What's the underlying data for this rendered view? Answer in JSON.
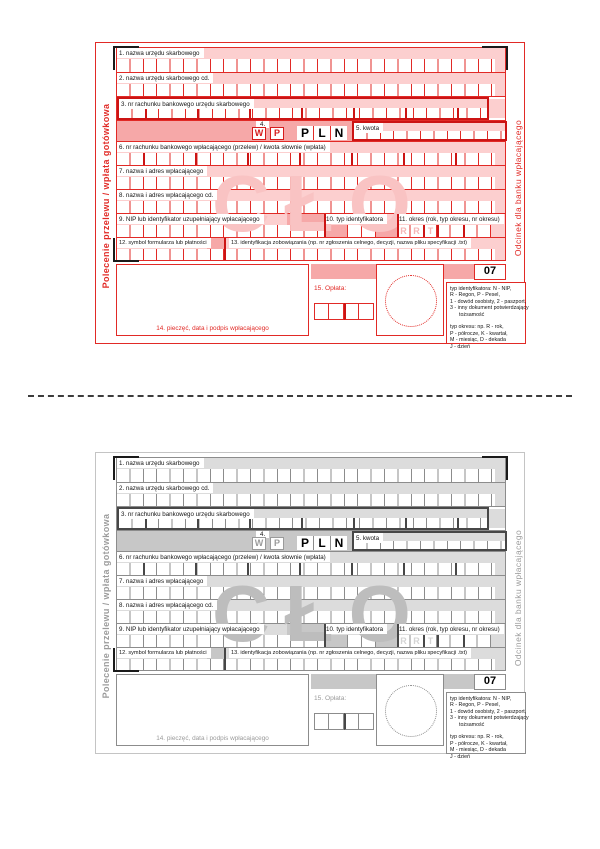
{
  "form": {
    "side_left": "Polecenie przelewu / wpłata gotówkowa",
    "side_right": "Odcinek dla banku wpłacającego",
    "watermark": "CŁO",
    "currency": [
      "P",
      "L",
      "N"
    ],
    "period_watermark": [
      "R",
      "R",
      "T"
    ],
    "form_code": "07",
    "fields": {
      "f1": "1. nazwa urzędu skarbowego",
      "f2": "2. nazwa urzędu skarbowego cd.",
      "f3": "3. nr rachunku bankowego urzędu skarbowego",
      "f4": "4.",
      "f4_w": "W",
      "f4_p": "P",
      "f5": "5. kwota",
      "f6": "6. nr rachunku bankowego wpłacającego (przelew) / kwota słownie (wpłata)",
      "f7": "7. nazwa i adres wpłacającego",
      "f8": "8. nazwa i adres wpłacającego cd.",
      "f9": "9. NIP lub identyfikator uzupełniający wpłacającego",
      "f10": "10. typ identyfikatora",
      "f11": "11. okres (rok, typ okresu, nr okresu)",
      "f12": "12. symbol formularza lub płatności",
      "f13": "13. identyfikacja zobowiązania (np. nr zgłoszenia celnego, decyzji, nazwa pliku specyfikacji .txt)",
      "f14": "14. pieczęć, data i podpis wpłacającego",
      "f15": "15. Opłata:"
    },
    "legend_lines": [
      "typ identyfikatora:  N - NIP,",
      "R - Regon, P - Pesel,",
      "1 - dowód osobisty, 2 - paszport,",
      "3 - inny dokument potwierdzający",
      "tożsamość",
      "",
      "typ okresu: np. R - rok,",
      "P - półrocze, K - kwartał,",
      "M - miesiąc, D - dekada",
      "J - dzień"
    ]
  },
  "colors": {
    "red_accent": "#e12a26",
    "red_fill_light": "#fccfcf",
    "red_fill_band": "#f6a8a8",
    "gray_accent": "#8c8c8c",
    "gray_fill_light": "#dcdcdc",
    "gray_fill_band": "#c7c7c7",
    "crop_mark": "#1a1a1a"
  }
}
